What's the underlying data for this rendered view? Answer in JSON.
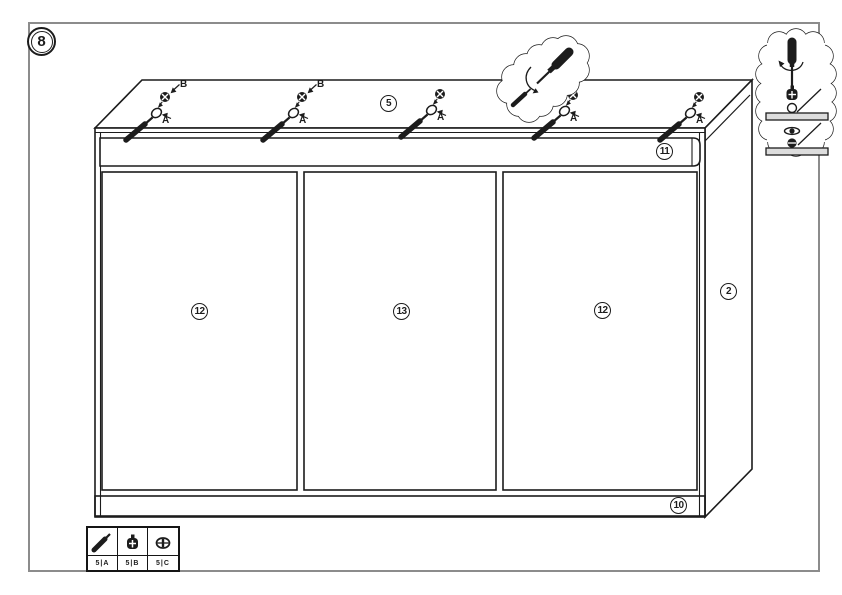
{
  "step": {
    "number": "8"
  },
  "callouts": {
    "screw_pack": "5",
    "top_rail": "11",
    "left_door": "12",
    "center_door": "13",
    "right_door": "12",
    "side_panel": "2",
    "bottom_rail": "10"
  },
  "fastener_labels": {
    "cam_position": "A",
    "screw_position": "B"
  },
  "legend": {
    "items": [
      {
        "code": "5|A",
        "icon": "screw-icon"
      },
      {
        "code": "5|B",
        "icon": "cam-bolt-icon"
      },
      {
        "code": "5|C",
        "icon": "cam-lock-icon"
      }
    ]
  },
  "colors": {
    "line": "#1c1c1c",
    "frame_border": "#8c8c8c",
    "background": "#ffffff",
    "panel_fill": "#dddddd"
  }
}
